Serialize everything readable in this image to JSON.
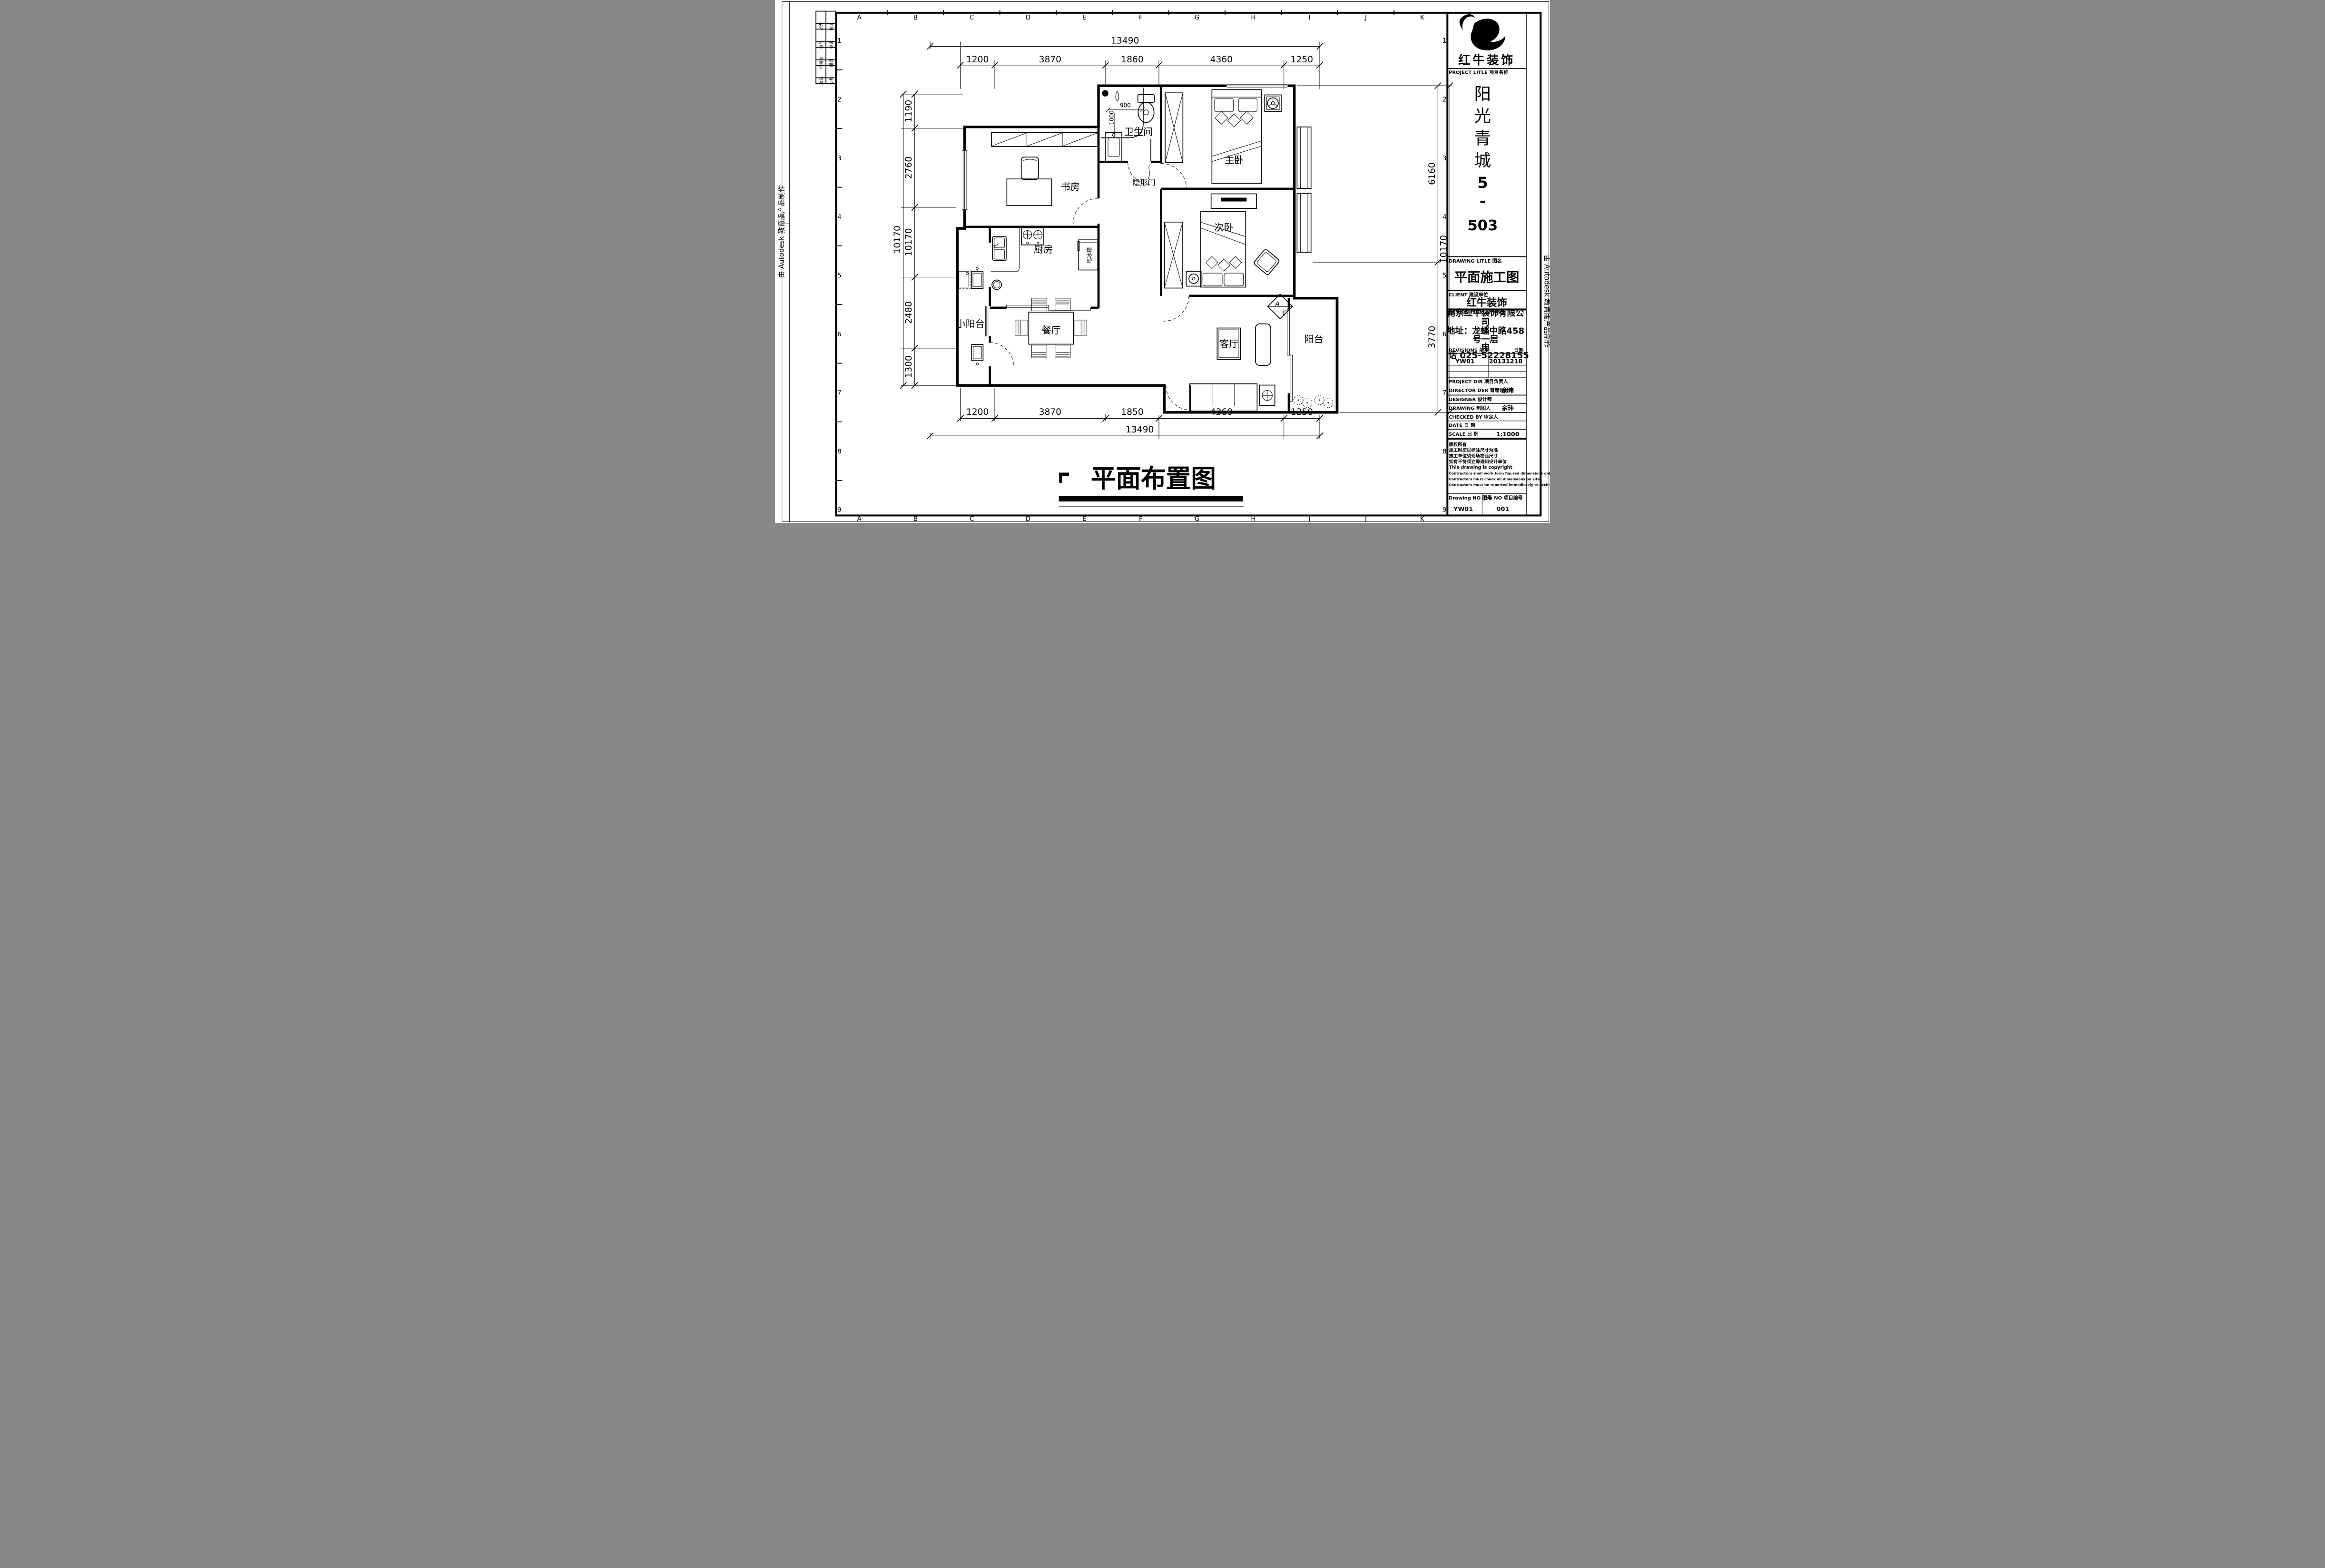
{
  "plan": {
    "rooms": {
      "study": "书房",
      "kitchen": "厨房",
      "small_balcony": "小阳台",
      "dining": "餐厅",
      "bathroom": "卫生间",
      "master_bedroom": "主卧",
      "second_bedroom": "次卧",
      "living_room": "客厅",
      "balcony": "阳台"
    },
    "annotations": {
      "hidden_door": "隐形门",
      "fridge": "电冰箱",
      "ac_top": "A",
      "ac_bottom": "C",
      "shower_width": "900",
      "shower_depth": "1000"
    }
  },
  "dimensions": {
    "top": {
      "total": "13490",
      "segments": [
        "1200",
        "3870",
        "1860",
        "4360",
        "1250"
      ]
    },
    "bottom": {
      "total": "13490",
      "segments": [
        "1200",
        "3870",
        "1850",
        "4360",
        "1250"
      ]
    },
    "left": {
      "total": "10170",
      "segments": [
        "1190",
        "2760",
        "10170",
        "2480",
        "1300"
      ]
    },
    "right": {
      "total": "10170",
      "segments": [
        "6160",
        "3770"
      ]
    }
  },
  "grid": {
    "letters": [
      "A",
      "B",
      "C",
      "D",
      "E",
      "F",
      "G",
      "H",
      "I",
      "J",
      "K"
    ],
    "numbers": [
      "1",
      "2",
      "3",
      "4",
      "5",
      "6",
      "7",
      "8",
      "9"
    ]
  },
  "margin_table": {
    "rows": [
      [
        "动力",
        "校工"
      ],
      [
        "电气",
        "电讯"
      ],
      [
        "给排水",
        "暖通"
      ],
      [
        "建筑",
        "结构"
      ]
    ]
  },
  "watermark": "由 Autodesk 教育版产品制作",
  "title_block": {
    "brand": "红牛装饰",
    "project_label": "PROJECT LITLE 项目名称",
    "project_name": [
      "阳",
      "光",
      "青",
      "城",
      "5",
      "-",
      "503"
    ],
    "drawing_title_label": "DRAWING LITLE 图名",
    "drawing_title": "平面施工图",
    "client_label": "CLIENT 建设单位",
    "client": "红牛装饰",
    "firm_label": "DESIGN FIRM 设计单位",
    "firm_lines": [
      "南京红牛装饰有限公",
      "司",
      "地址：龙蟠中路458",
      "号一层",
      "电",
      "话 025-52228155"
    ],
    "revisions_label": "REVISIONS 版本",
    "date_label": "日期",
    "revision_no": "YW01",
    "revision_date": "20131218",
    "staff": [
      {
        "label": "PROJECT DIR 项目负责人",
        "value": ""
      },
      {
        "label": "DIRECTOR DER 首席设计师",
        "value": "余玮"
      },
      {
        "label": "DESIGNER 设计师",
        "value": ""
      },
      {
        "label": "DRAWING 制图人",
        "value": "余玮"
      },
      {
        "label": "CHECKED BY 审定人",
        "value": ""
      },
      {
        "label": "DATE 日 期",
        "value": ""
      },
      {
        "label": "SCALE 比 例",
        "value": "1:1000"
      }
    ],
    "copyright_lines": [
      "版权所有",
      "施工时须以标注尺寸为准",
      "施工单位须现场校验尺寸",
      "如有不符须立即通知设计单位",
      "This drawing is copyright",
      "Contractors shall work form figured dimensions only",
      "Contractors must check all dimensions on site",
      "Contractors must be reported immediately to architects"
    ],
    "drawing_no_label": "Drawing NO 图号",
    "job_no_label": "Job NO 项目编号",
    "drawing_no": "YW01",
    "job_no": "001"
  },
  "footer_title": "平面布置图"
}
